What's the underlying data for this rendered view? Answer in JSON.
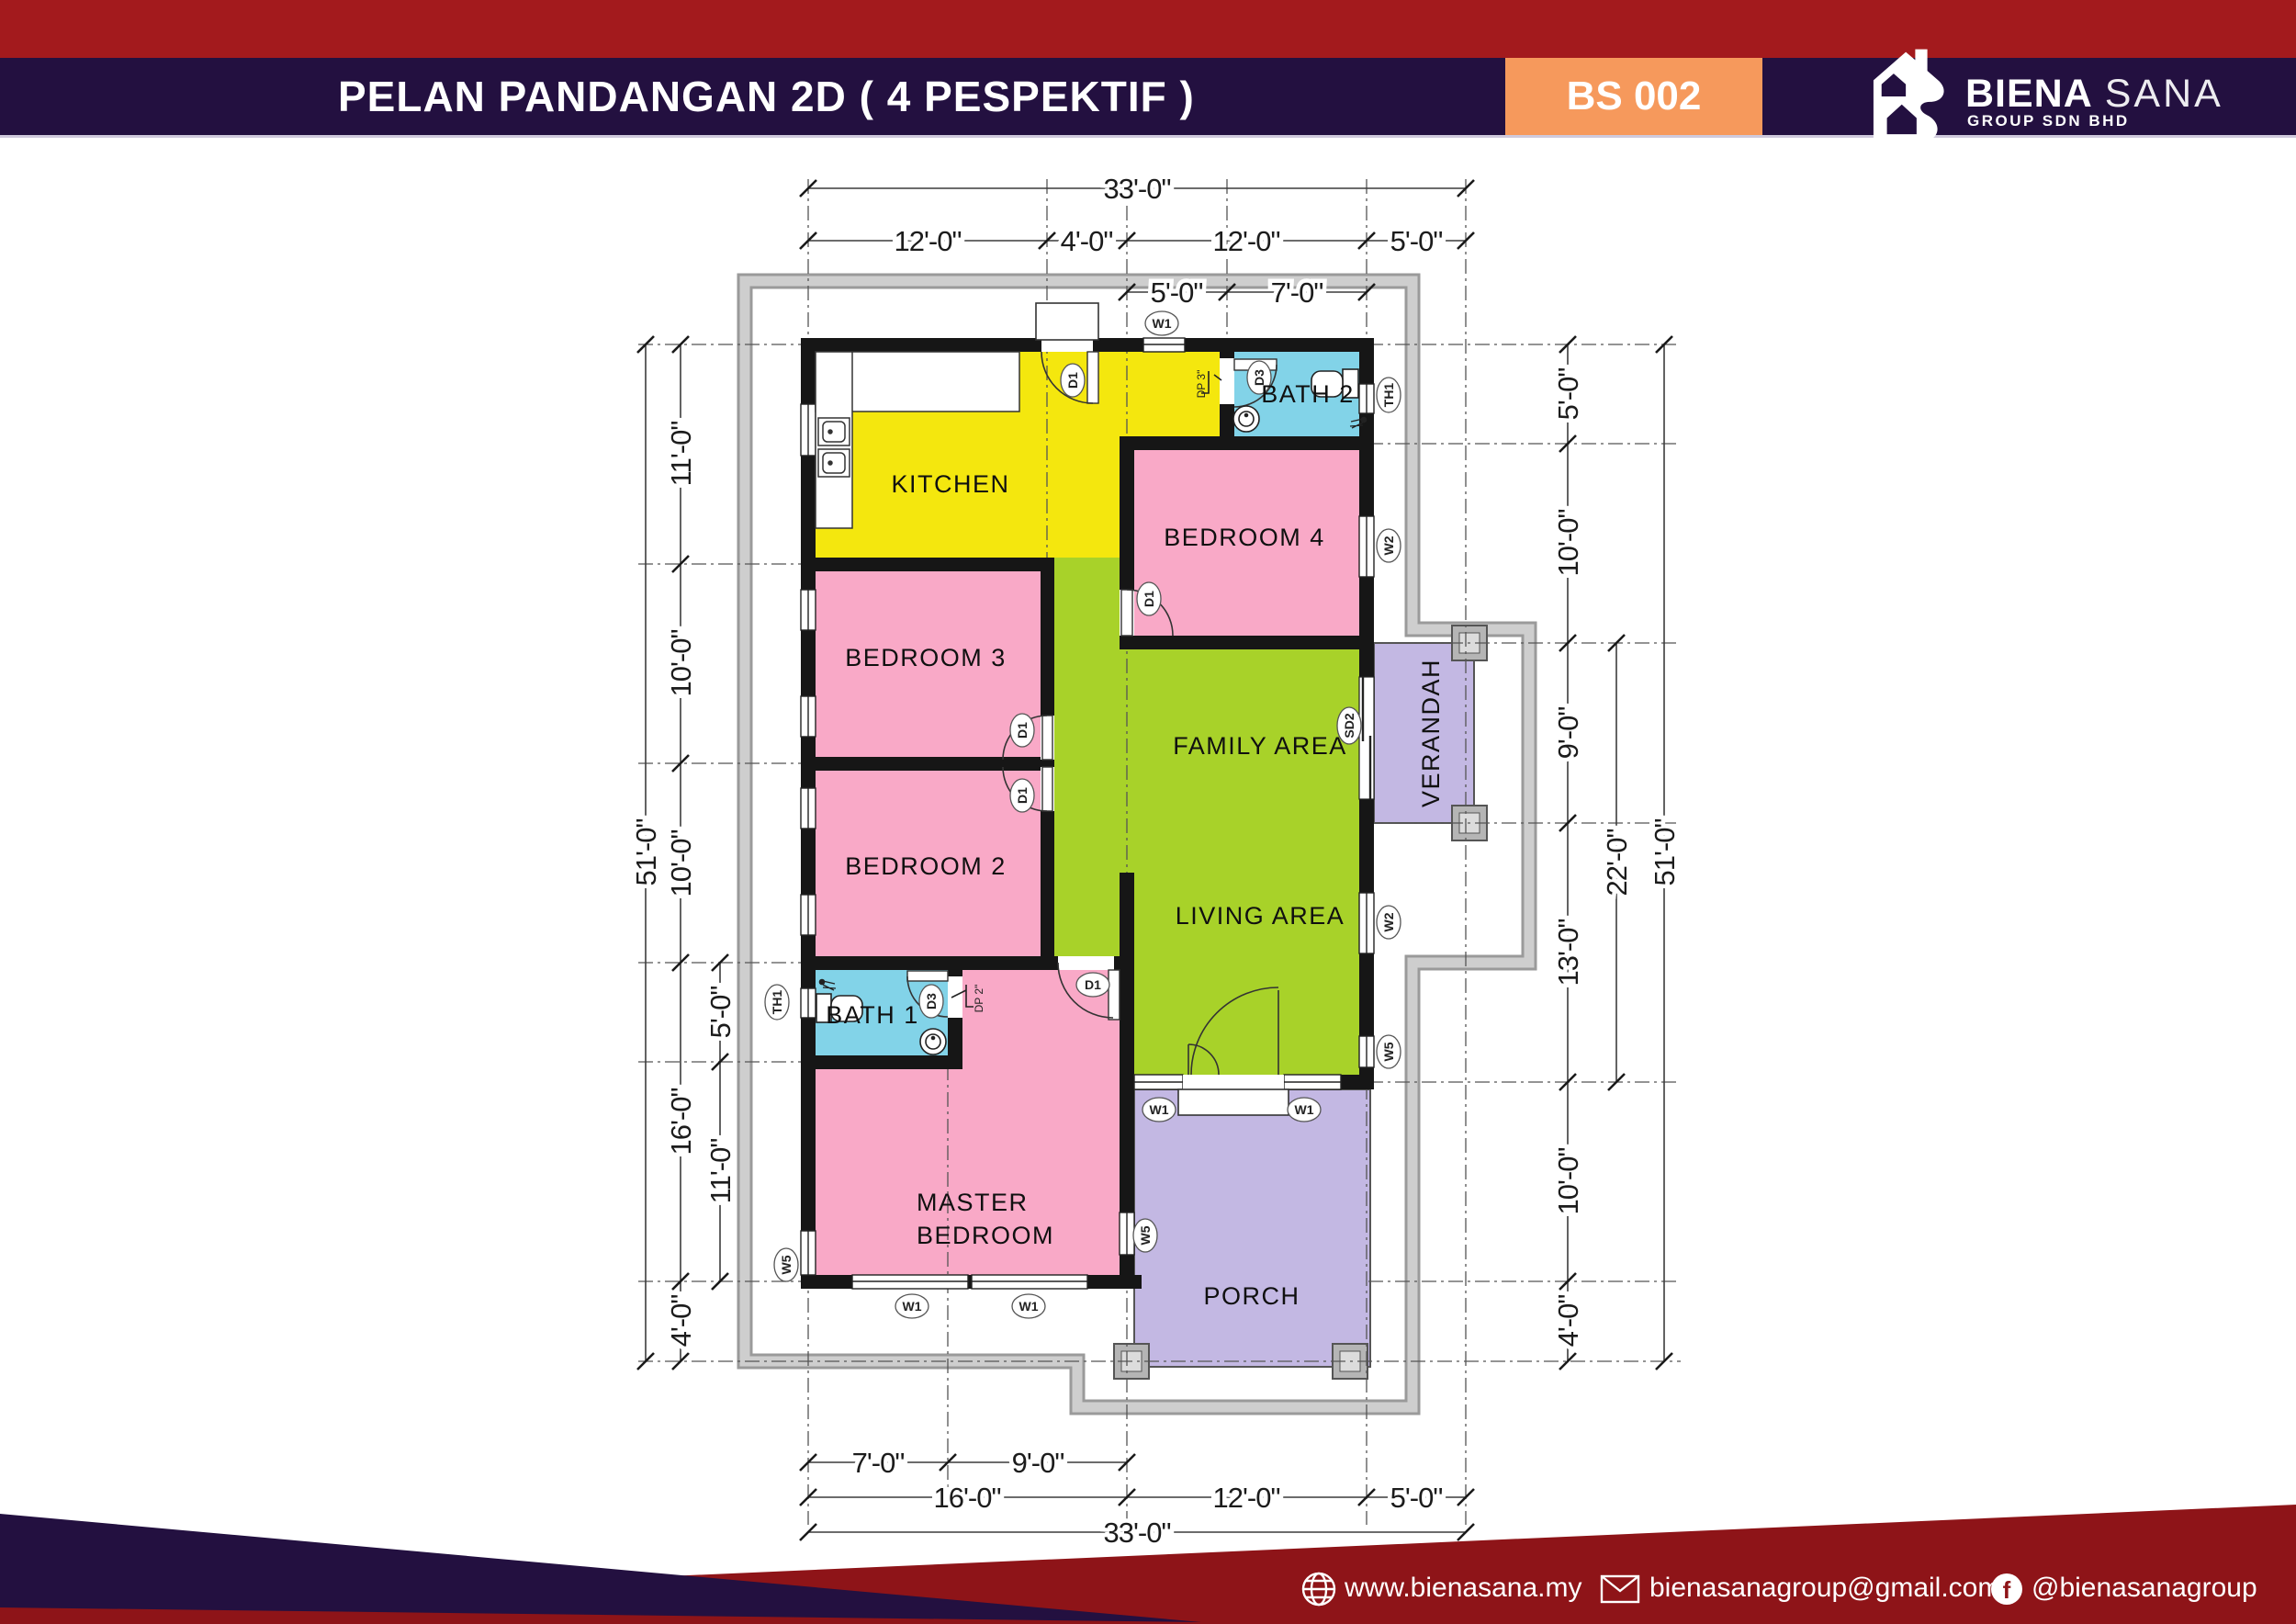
{
  "header": {
    "title": "PELAN PANDANGAN 2D ( 4 PESPEKTIF )",
    "badge": "BS 002",
    "brand_bold": "BIENA",
    "brand_light": "SANA",
    "brand_sub": "GROUP SDN BHD"
  },
  "footer": {
    "website": "www.bienasana.my",
    "email": "bienasanagroup@gmail.com",
    "social": "@bienasanagroup"
  },
  "rooms": {
    "kitchen": "KITCHEN",
    "bath2": "BATH 2",
    "bedroom4": "BEDROOM 4",
    "bedroom3": "BEDROOM 3",
    "bedroom2": "BEDROOM 2",
    "family": "FAMILY AREA",
    "living": "LIVING AREA",
    "verandah": "VERANDAH",
    "bath1": "BATH 1",
    "master1": "MASTER",
    "master2": "BEDROOM",
    "porch": "PORCH"
  },
  "tags": {
    "w1": "W1",
    "w2": "W2",
    "w5": "W5",
    "d1": "D1",
    "d3": "D3",
    "sd2": "SD2",
    "th1": "TH1",
    "dp2": "DP 2\"",
    "dp3": "DP 3\""
  },
  "dims": {
    "overall_w_top": "33'-0\"",
    "overall_w_bottom": "33'-0\"",
    "overall_h_left": "51'-0\"",
    "overall_h_right": "51'-0\"",
    "top": [
      {
        "label": "12'-0\""
      },
      {
        "label": "4'-0\""
      },
      {
        "label": "12'-0\""
      },
      {
        "label": "5'-0\""
      }
    ],
    "top_sub": [
      {
        "label": "5'-0\""
      },
      {
        "label": "7'-0\""
      }
    ],
    "left": [
      {
        "label": "11'-0\""
      },
      {
        "label": "10'-0\""
      },
      {
        "label": "10'-0\""
      },
      {
        "label": "16'-0\""
      },
      {
        "label": "4'-0\""
      }
    ],
    "left_sub": [
      {
        "label": "5'-0\""
      },
      {
        "label": "11'-0\""
      }
    ],
    "right": [
      {
        "label": "5'-0\""
      },
      {
        "label": "10'-0\""
      },
      {
        "label": "9'-0\""
      },
      {
        "label": "13'-0\""
      },
      {
        "label": "10'-0\""
      },
      {
        "label": "4'-0\""
      }
    ],
    "right_sub": "22'-0\"",
    "bottom": [
      {
        "label": "7'-0\""
      },
      {
        "label": "9'-0\""
      }
    ],
    "bottom2": [
      {
        "label": "16'-0\""
      },
      {
        "label": "12'-0\""
      },
      {
        "label": "5'-0\""
      }
    ]
  },
  "colors": {
    "header_red": "#a31a1d",
    "header_navy": "#231040",
    "badge_orange": "#f6995c",
    "kitchen_yellow": "#f4e70e",
    "bedroom_pink": "#f9a9c7",
    "living_green": "#a8d229",
    "bath_cyan": "#82d3e8",
    "porch_lavender": "#c3b8e3",
    "apron_gray": "#c7c7c7",
    "wall_black": "#161616"
  }
}
